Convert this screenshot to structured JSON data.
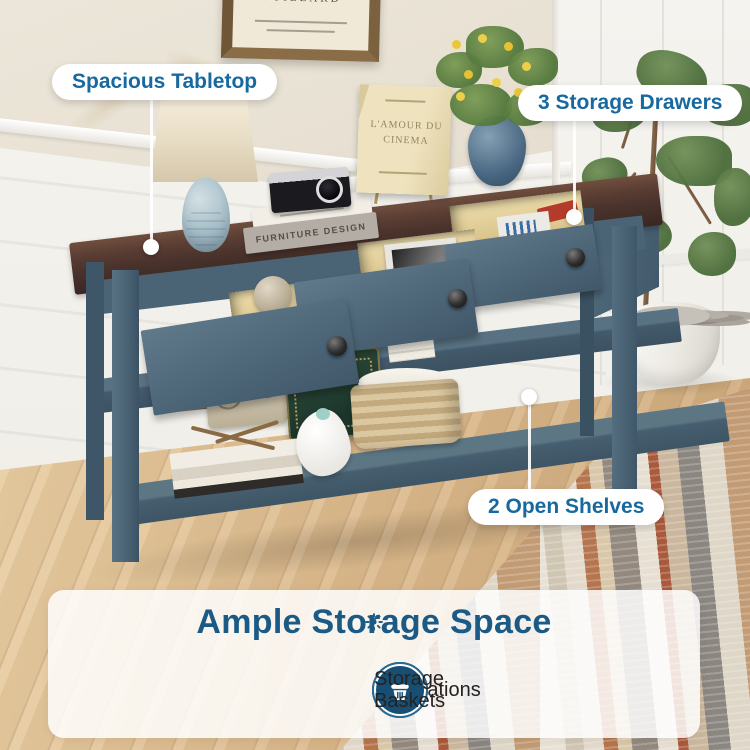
{
  "callouts": {
    "tabletop": {
      "label": "Spacious Tabletop"
    },
    "drawers": {
      "label": "3 Storage Drawers"
    },
    "shelves": {
      "label": "2 Open Shelves"
    }
  },
  "banner": {
    "title": "Ample Storage Space",
    "features": [
      {
        "label": "Decorations",
        "icon": "plant-icon"
      },
      {
        "label": "Keys",
        "icon": "key-icon"
      },
      {
        "label": "Mails",
        "icon": "mail-icon"
      },
      {
        "label": "Storage Baskets",
        "icon": "basket-icon"
      }
    ]
  },
  "scene": {
    "frame_title": "VUILLARD",
    "display_book_title": "L'AMOUR DU CINEMA",
    "book_spine_title": "FURNITURE DESIGN"
  },
  "colors": {
    "accent_blue": "#1a5a85",
    "pill_text": "#17699f",
    "icon_circle": "#174f74",
    "table_blue": "#4d6678",
    "table_top_brown": "#4a332c",
    "floor_wood": "#dcba8c"
  }
}
